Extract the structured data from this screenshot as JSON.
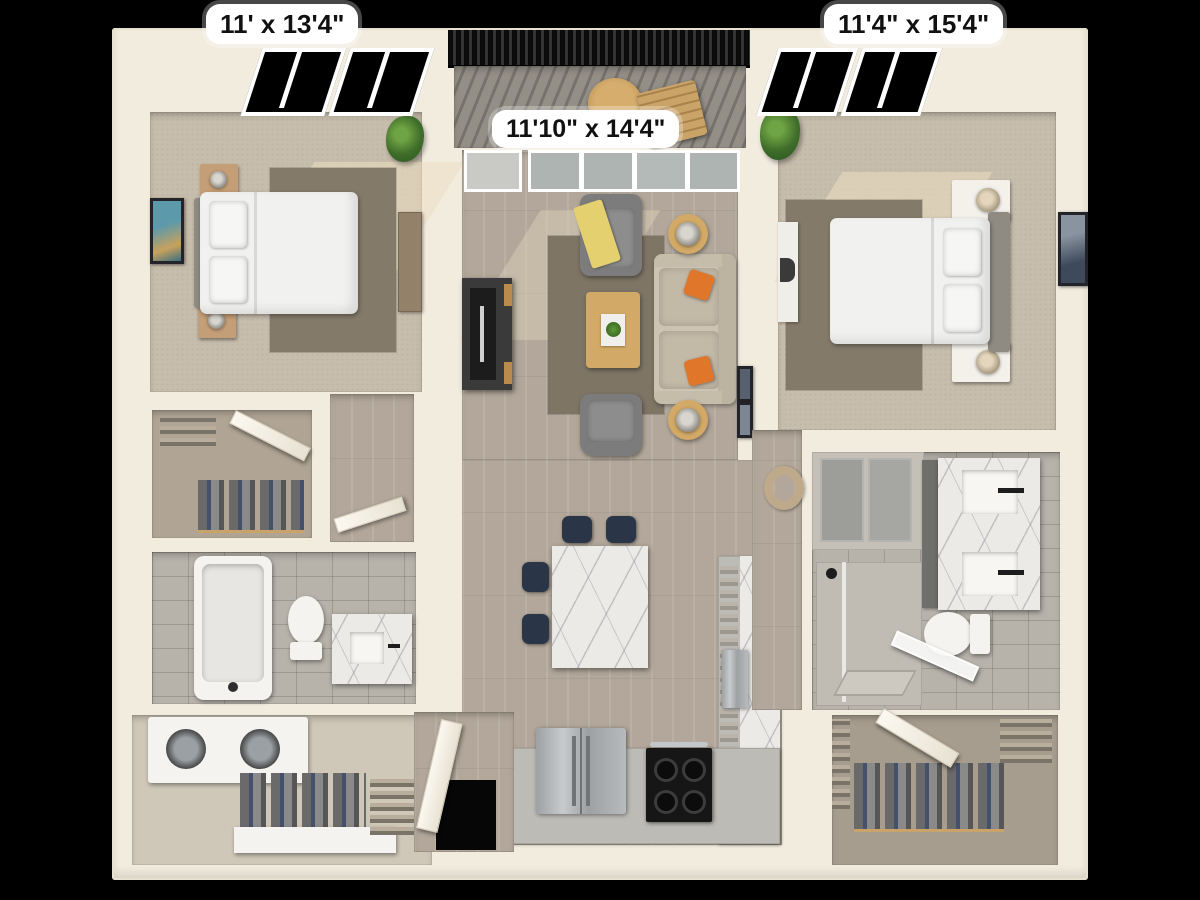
{
  "scene": {
    "kind": "3d-floor-plan-render",
    "background": "#000000",
    "rooms": [
      {
        "id": "bedroom-left",
        "dimensions": "11' x 13'4\""
      },
      {
        "id": "bedroom-right",
        "dimensions": "11'4\" x 15'4\""
      },
      {
        "id": "living-room",
        "dimensions": "11'10\" x 14'4\""
      },
      {
        "id": "balcony"
      },
      {
        "id": "kitchen"
      },
      {
        "id": "bathroom-left"
      },
      {
        "id": "bathroom-right"
      },
      {
        "id": "walk-in-closet-left"
      },
      {
        "id": "walk-in-closet-right"
      },
      {
        "id": "laundry-closet"
      },
      {
        "id": "entry"
      }
    ]
  },
  "dimension_labels": {
    "bedroom_left": "11' x 13'4\"",
    "bedroom_right": "11'4\" x 15'4\"",
    "living_room": "11'10\" x 14'4\""
  },
  "furniture": [
    "queen-bed-left",
    "queen-bed-right",
    "nightstands",
    "table-lamps",
    "wall-art",
    "potted-plants",
    "tv-console",
    "sofa",
    "armchairs",
    "coffee-table",
    "side-tables",
    "orange-throw-pillows",
    "yellow-throw-blanket",
    "area-rugs",
    "kitchen-island",
    "bar-stools",
    "refrigerator",
    "range-stove",
    "cabinets-counters",
    "bathtub",
    "toilets",
    "vanity-single",
    "vanity-double",
    "walk-in-shower",
    "washer-dryer",
    "hanging-clothes",
    "desk-chair",
    "balcony-lounge-chair",
    "balcony-table"
  ],
  "palette": {
    "background": "#000000",
    "wall_cream": "#f2ecdf",
    "wood_floor": "#b2a79a",
    "carpet": "#c7bdac",
    "area_rug": "#847a6a",
    "bath_tile": "#b7b3ab",
    "deck_gray": "#8f8a83",
    "railing_black": "#141414",
    "sofa_beige": "#cdc3b1",
    "chair_gray": "#7c7c7c",
    "pillow_orange": "#e0762a",
    "throw_yellow": "#e4d06e",
    "wood_table": "#d2a966",
    "marble": "#eceae7",
    "stool_navy": "#2a3647",
    "stainless": "#aab0b2",
    "stove_black": "#161616",
    "plant_green": "#4d7a33",
    "label_bg": "#ffffff",
    "label_text": "#111111"
  }
}
